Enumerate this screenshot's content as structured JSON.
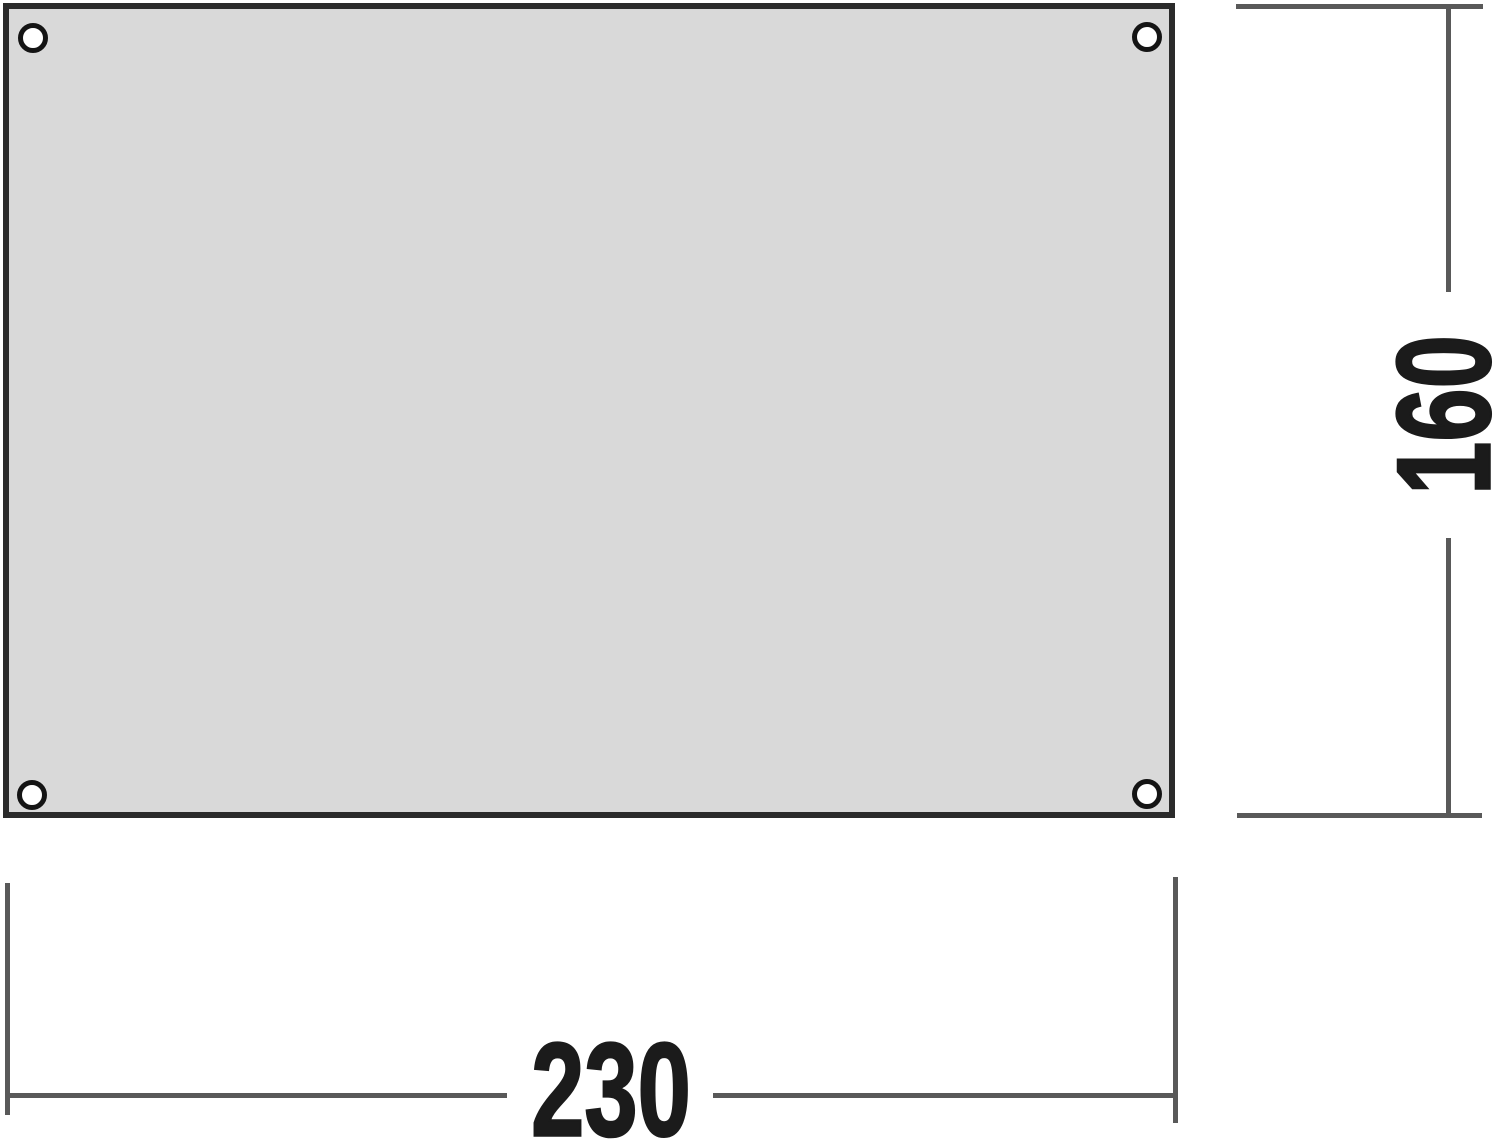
{
  "diagram": {
    "type": "dimension-drawing",
    "subject": "rectangular groundsheet with corner grommets",
    "width_dimension": {
      "label": "230"
    },
    "height_dimension": {
      "label": "160"
    },
    "grommets": {
      "count": 4,
      "icon": "grommet-circle-icon"
    },
    "colors": {
      "background": "#ffffff",
      "sheet_fill": "#d9d9d9",
      "sheet_border": "#2b2b2b",
      "line_color": "#595959",
      "dimension_text": "#1b1b1b",
      "grommet_ring": "#141414",
      "grommet_fill": "#ffffff"
    }
  }
}
